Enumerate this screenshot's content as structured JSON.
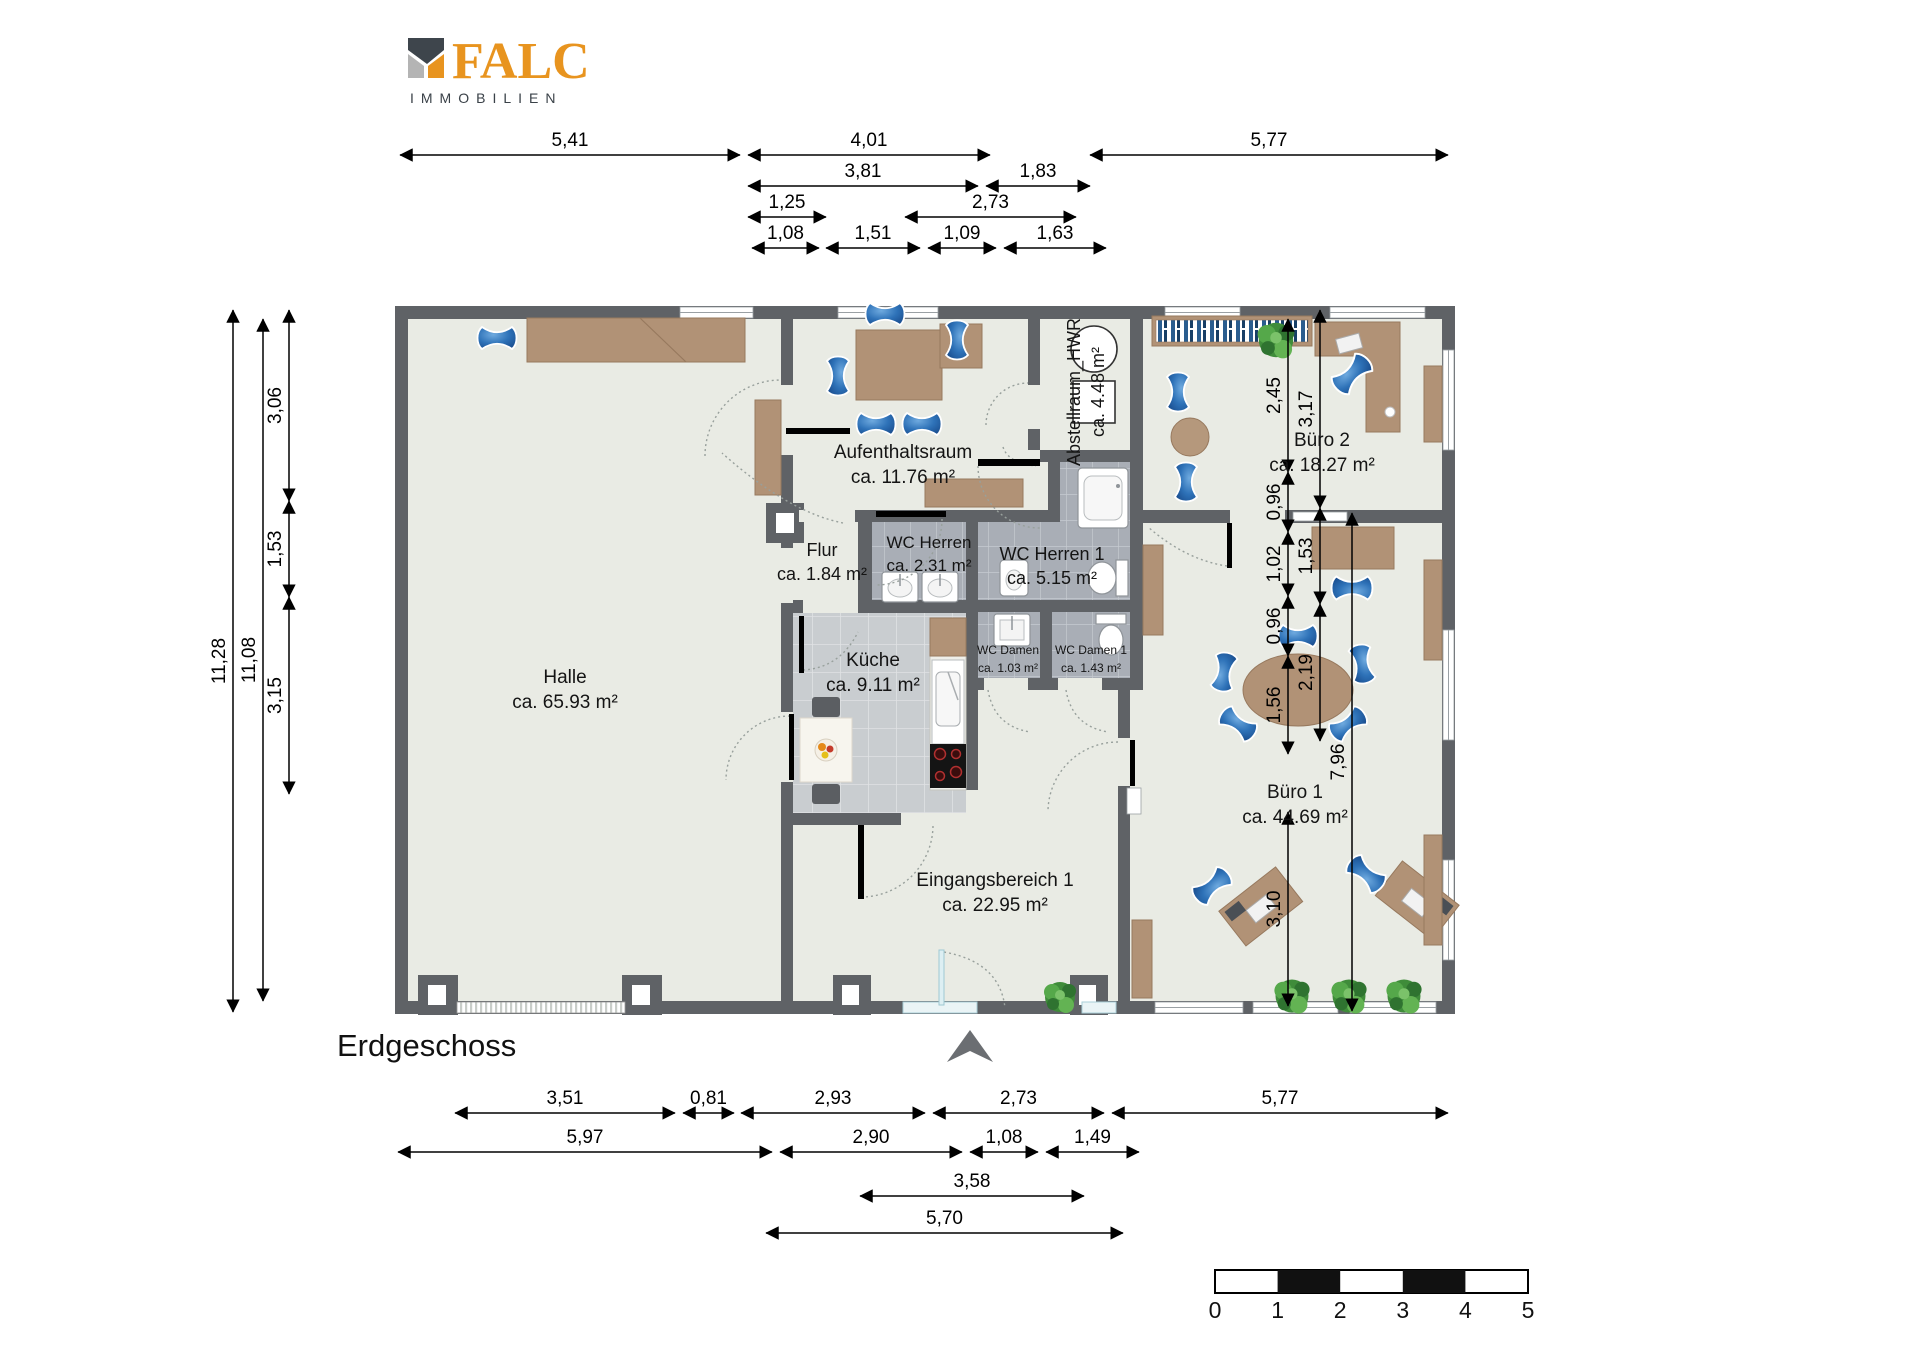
{
  "meta": {
    "floor_title": "Erdgeschoss"
  },
  "logo": {
    "title": "FALC",
    "subtitle": "IMMOBILIEN",
    "orange": "#E8941F",
    "dark": "#3A4148",
    "gray": "#B4B4B4"
  },
  "scale_bar": {
    "labels": [
      "0",
      "1",
      "2",
      "3",
      "4",
      "5"
    ]
  },
  "rooms": [
    {
      "name": "Halle",
      "area": "ca. 65.93 m²",
      "x": 565,
      "y": 683,
      "size": 19
    },
    {
      "name": "Aufenthaltsraum",
      "area": "ca. 11.76 m²",
      "x": 903,
      "y": 458,
      "size": 19
    },
    {
      "name": "Abstellraum_HWR",
      "area": "ca. 4.48 m²",
      "x": 1080,
      "y": 392,
      "size": 18,
      "rotate": -90
    },
    {
      "name": "Büro 2",
      "area": "ca. 18.27 m²",
      "x": 1322,
      "y": 446,
      "size": 19
    },
    {
      "name": "Flur",
      "area": "ca. 1.84 m²",
      "x": 822,
      "y": 556,
      "size": 18
    },
    {
      "name": "WC Herren",
      "area": "ca. 2.31 m²",
      "x": 929,
      "y": 548,
      "size": 17
    },
    {
      "name": "WC Herren 1",
      "area": "ca. 5.15 m²",
      "x": 1052,
      "y": 560,
      "size": 18
    },
    {
      "name": "WC Damen",
      "area": "ca. 1.03 m²",
      "x": 1008,
      "y": 654,
      "size": 12
    },
    {
      "name": "WC Damen 1",
      "area": "ca. 1.43 m²",
      "x": 1091,
      "y": 654,
      "size": 12
    },
    {
      "name": "Küche",
      "area": "ca. 9.11 m²",
      "x": 873,
      "y": 666,
      "size": 19
    },
    {
      "name": "Büro 1",
      "area": "ca. 44.69 m²",
      "x": 1295,
      "y": 798,
      "size": 19
    },
    {
      "name": "Eingangsbereich 1",
      "area": "ca. 22.95 m²",
      "x": 995,
      "y": 886,
      "size": 19
    }
  ],
  "dimensions": {
    "top": [
      {
        "label": "5,41",
        "x1": 400,
        "x2": 740,
        "y": 155
      },
      {
        "label": "4,01",
        "x1": 748,
        "x2": 990,
        "y": 155
      },
      {
        "label": "5,77",
        "x1": 1090,
        "x2": 1448,
        "y": 155
      },
      {
        "label": "3,81",
        "x1": 748,
        "x2": 978,
        "y": 186
      },
      {
        "label": "1,83",
        "x1": 986,
        "x2": 1090,
        "y": 186
      },
      {
        "label": "1,25",
        "x1": 748,
        "x2": 826,
        "y": 217
      },
      {
        "label": "2,73",
        "x1": 905,
        "x2": 1076,
        "y": 217
      },
      {
        "label": "1,08",
        "x1": 752,
        "x2": 819,
        "y": 248
      },
      {
        "label": "1,51",
        "x1": 826,
        "x2": 920,
        "y": 248
      },
      {
        "label": "1,09",
        "x1": 928,
        "x2": 996,
        "y": 248
      },
      {
        "label": "1,63",
        "x1": 1004,
        "x2": 1106,
        "y": 248
      }
    ],
    "bottom": [
      {
        "label": "3,51",
        "x1": 455,
        "x2": 675,
        "y": 1113
      },
      {
        "label": "0,81",
        "x1": 683,
        "x2": 734,
        "y": 1113
      },
      {
        "label": "2,93",
        "x1": 741,
        "x2": 925,
        "y": 1113
      },
      {
        "label": "2,73",
        "x1": 933,
        "x2": 1104,
        "y": 1113
      },
      {
        "label": "5,77",
        "x1": 1112,
        "x2": 1448,
        "y": 1113
      },
      {
        "label": "5,97",
        "x1": 398,
        "x2": 772,
        "y": 1152
      },
      {
        "label": "2,90",
        "x1": 780,
        "x2": 962,
        "y": 1152
      },
      {
        "label": "1,08",
        "x1": 970,
        "x2": 1038,
        "y": 1152
      },
      {
        "label": "1,49",
        "x1": 1046,
        "x2": 1139,
        "y": 1152
      },
      {
        "label": "3,58",
        "x1": 860,
        "x2": 1084,
        "y": 1196
      },
      {
        "label": "5,70",
        "x1": 766,
        "x2": 1123,
        "y": 1233
      }
    ],
    "left": [
      {
        "label": "11,28",
        "y1": 310,
        "y2": 1012,
        "x": 233
      },
      {
        "label": "11,08",
        "y1": 319,
        "y2": 1001,
        "x": 263
      },
      {
        "label": "3,06",
        "y1": 310,
        "y2": 501,
        "x": 289
      },
      {
        "label": "1,53",
        "y1": 501,
        "y2": 597,
        "x": 289
      },
      {
        "label": "3,15",
        "y1": 597,
        "y2": 794,
        "x": 289
      }
    ],
    "right": [
      {
        "label": "2,45",
        "y1": 319,
        "y2": 472,
        "x": 1288
      },
      {
        "label": "0,96",
        "y1": 472,
        "y2": 532,
        "x": 1288
      },
      {
        "label": "1,02",
        "y1": 532,
        "y2": 596,
        "x": 1288
      },
      {
        "label": "0,96",
        "y1": 596,
        "y2": 656,
        "x": 1288
      },
      {
        "label": "1,56",
        "y1": 656,
        "y2": 754,
        "x": 1288
      },
      {
        "label": "3,10",
        "y1": 812,
        "y2": 1006,
        "x": 1288
      },
      {
        "label": "3,17",
        "y1": 310,
        "y2": 508,
        "x": 1320
      },
      {
        "label": "1,53",
        "y1": 508,
        "y2": 604,
        "x": 1320
      },
      {
        "label": "2,19",
        "y1": 604,
        "y2": 741,
        "x": 1320
      },
      {
        "label": "7,96",
        "y1": 513,
        "y2": 1011,
        "x": 1352
      }
    ]
  }
}
